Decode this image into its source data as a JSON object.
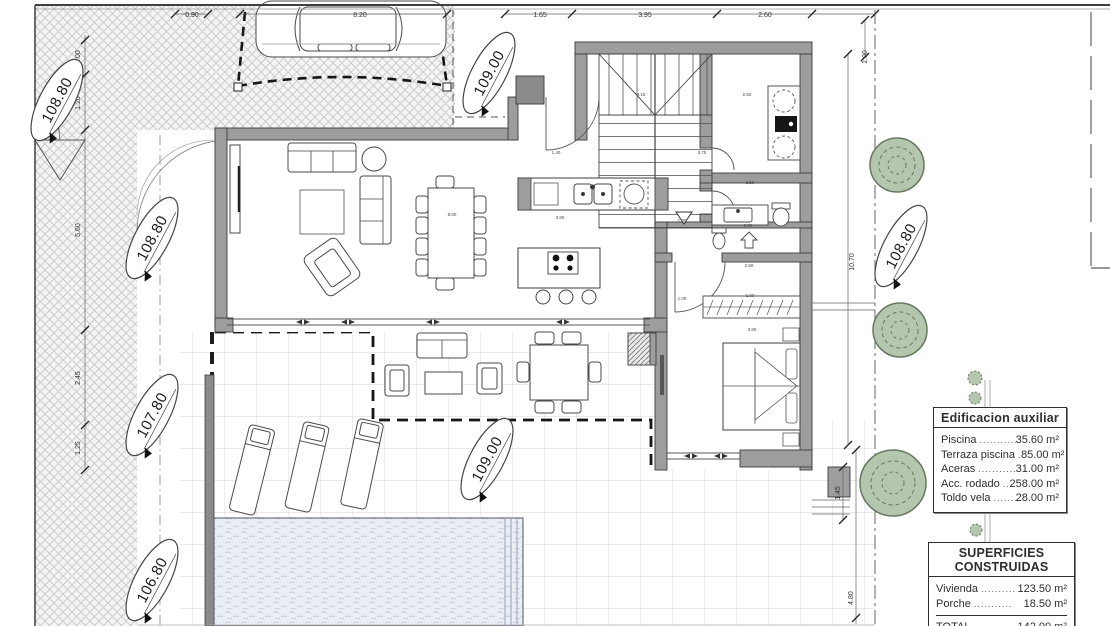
{
  "plan": {
    "legend_auxiliar": {
      "title": "Edificacion auxiliar",
      "rows": [
        {
          "label": "Piscina",
          "dots": "............",
          "value": "35.60 m²"
        },
        {
          "label": "Terraza piscina",
          "dots": "......",
          "value": "85.00 m²"
        },
        {
          "label": "Aceras",
          "dots": "............",
          "value": "31.00 m²"
        },
        {
          "label": "Acc. rodado",
          "dots": ".........",
          "value": "258.00 m²"
        },
        {
          "label": "Toldo vela",
          "dots": "...........",
          "value": "28.00 m²"
        }
      ]
    },
    "legend_superficies": {
      "title": "SUPERFICIES CONSTRUIDAS",
      "rows": [
        {
          "label": "Vivienda",
          "dots": "...........",
          "value": "123.50 m²"
        },
        {
          "label": "Porche",
          "dots": "...........",
          "value": "18.50 m²"
        }
      ],
      "total_label": "TOTAL",
      "total_dots": "...........",
      "total_value": "142.00 m²"
    },
    "elevation_markers": [
      {
        "value": "108.80"
      },
      {
        "value": "109.00"
      },
      {
        "value": "108.80"
      },
      {
        "value": "107.80"
      },
      {
        "value": "106.80"
      },
      {
        "value": "109.00"
      },
      {
        "value": "108.80"
      }
    ],
    "dimensions": [
      {
        "text": "0.90"
      },
      {
        "text": "8.20"
      },
      {
        "text": "1.65"
      },
      {
        "text": "3.95"
      },
      {
        "text": "2.60"
      },
      {
        "text": "1.00"
      },
      {
        "text": "1.00"
      },
      {
        "text": "1.20"
      },
      {
        "text": "5.60"
      },
      {
        "text": "2.45"
      },
      {
        "text": "1.25"
      },
      {
        "text": "10.70"
      },
      {
        "text": "1.45"
      },
      {
        "text": "4.80"
      },
      {
        "text": "3.15"
      },
      {
        "text": "2.50"
      },
      {
        "text": "1.40"
      },
      {
        "text": "3.75"
      },
      {
        "text": "8.00"
      },
      {
        "text": "3.80"
      },
      {
        "text": "2.00"
      },
      {
        "text": "2.50"
      },
      {
        "text": "2.50"
      },
      {
        "text": "1.00"
      },
      {
        "text": "1.00"
      },
      {
        "text": "3.80"
      },
      {
        "text": "1.00"
      }
    ],
    "colors": {
      "wall": "#9d9d9d",
      "tree_fill": "#b5c6ae",
      "tree_stroke": "#66795f",
      "water": "#e9edf4",
      "hatch_line": "#c6c6c6",
      "grid_line": "#c9c9c9"
    }
  }
}
